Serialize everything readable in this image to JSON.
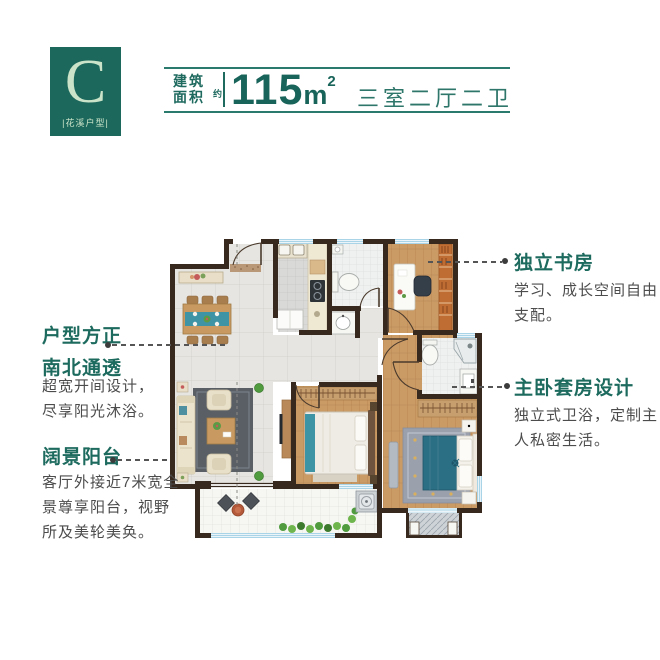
{
  "badge": {
    "letter": "C",
    "label": "|花溪户型|"
  },
  "header": {
    "area_label": [
      "建筑",
      "面积"
    ],
    "approx": "约",
    "value": "115",
    "unit": "m",
    "sup": "2",
    "rooms": "三室二厅二卫"
  },
  "callouts": {
    "huxing": {
      "heading": [
        "户型方正",
        "南北通透"
      ],
      "body": [
        "超宽开间设计，",
        "尽享阳光沐浴。"
      ]
    },
    "balcony": {
      "heading": [
        "阔景阳台"
      ],
      "body": [
        "客厅外接近7米宽全",
        "景尊享阳台，视野",
        "所及美轮美奂。"
      ]
    },
    "study": {
      "heading": [
        "独立书房"
      ],
      "body": [
        "学习、成长空间自由",
        "支配。"
      ]
    },
    "master": {
      "heading": [
        "主卧套房设计"
      ],
      "body": [
        "独立式卫浴，定制主",
        "人私密生活。"
      ]
    }
  },
  "colors": {
    "brand": "#1d685c",
    "badge_text": "#cbe4c9",
    "heading": "#1d6a5e",
    "body_text": "#4c4c4c",
    "rule": "#2a7a6e",
    "wall": "#38291f",
    "wood_floor": "#cb9b66",
    "marble_floor": "#e6e5e1",
    "window": "#a9d3e6",
    "living_rug": "#5a5f66",
    "master_bed": "#2b6f85",
    "bookshelf": "#bf6d33"
  }
}
